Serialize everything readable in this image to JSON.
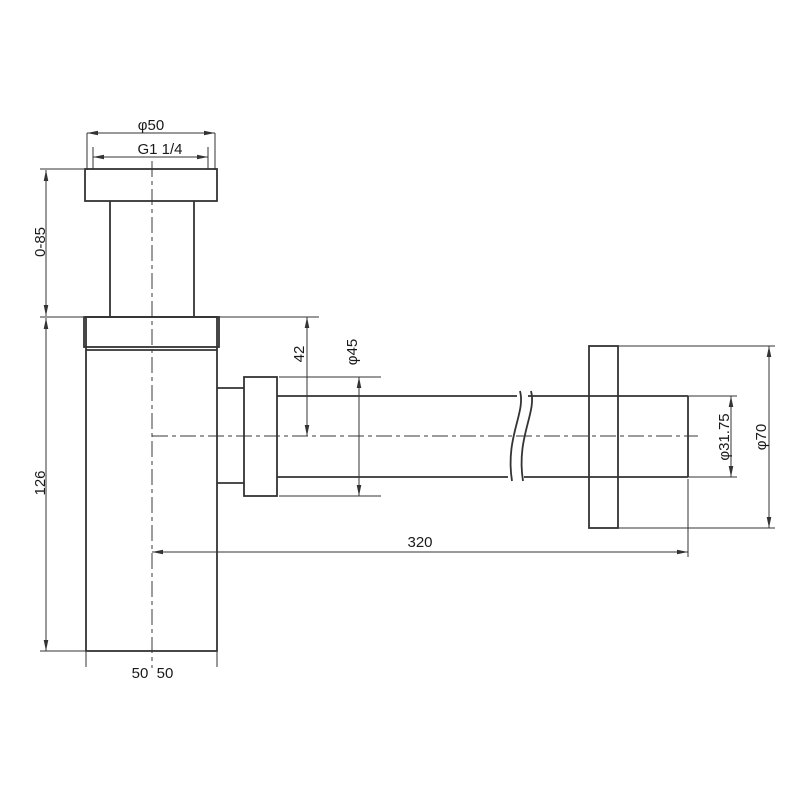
{
  "drawing": {
    "type": "technical-drawing",
    "subject": "bottle trap with wall outlet pipe - dimensional drawing",
    "background_color": "#ffffff",
    "line_color": "#333333",
    "text_color": "#1a1a1a",
    "labels": {
      "flange_diameter": "φ50",
      "thread": "G1 1/4",
      "adjustable_height": "0-85",
      "body_height": "126",
      "outlet_drop": "42",
      "nut_diameter": "φ45",
      "outlet_length": "320",
      "pipe_diameter": "φ31.75",
      "wall_flange_diameter": "φ70",
      "half_width_left": "50",
      "half_width_right": "50"
    }
  }
}
